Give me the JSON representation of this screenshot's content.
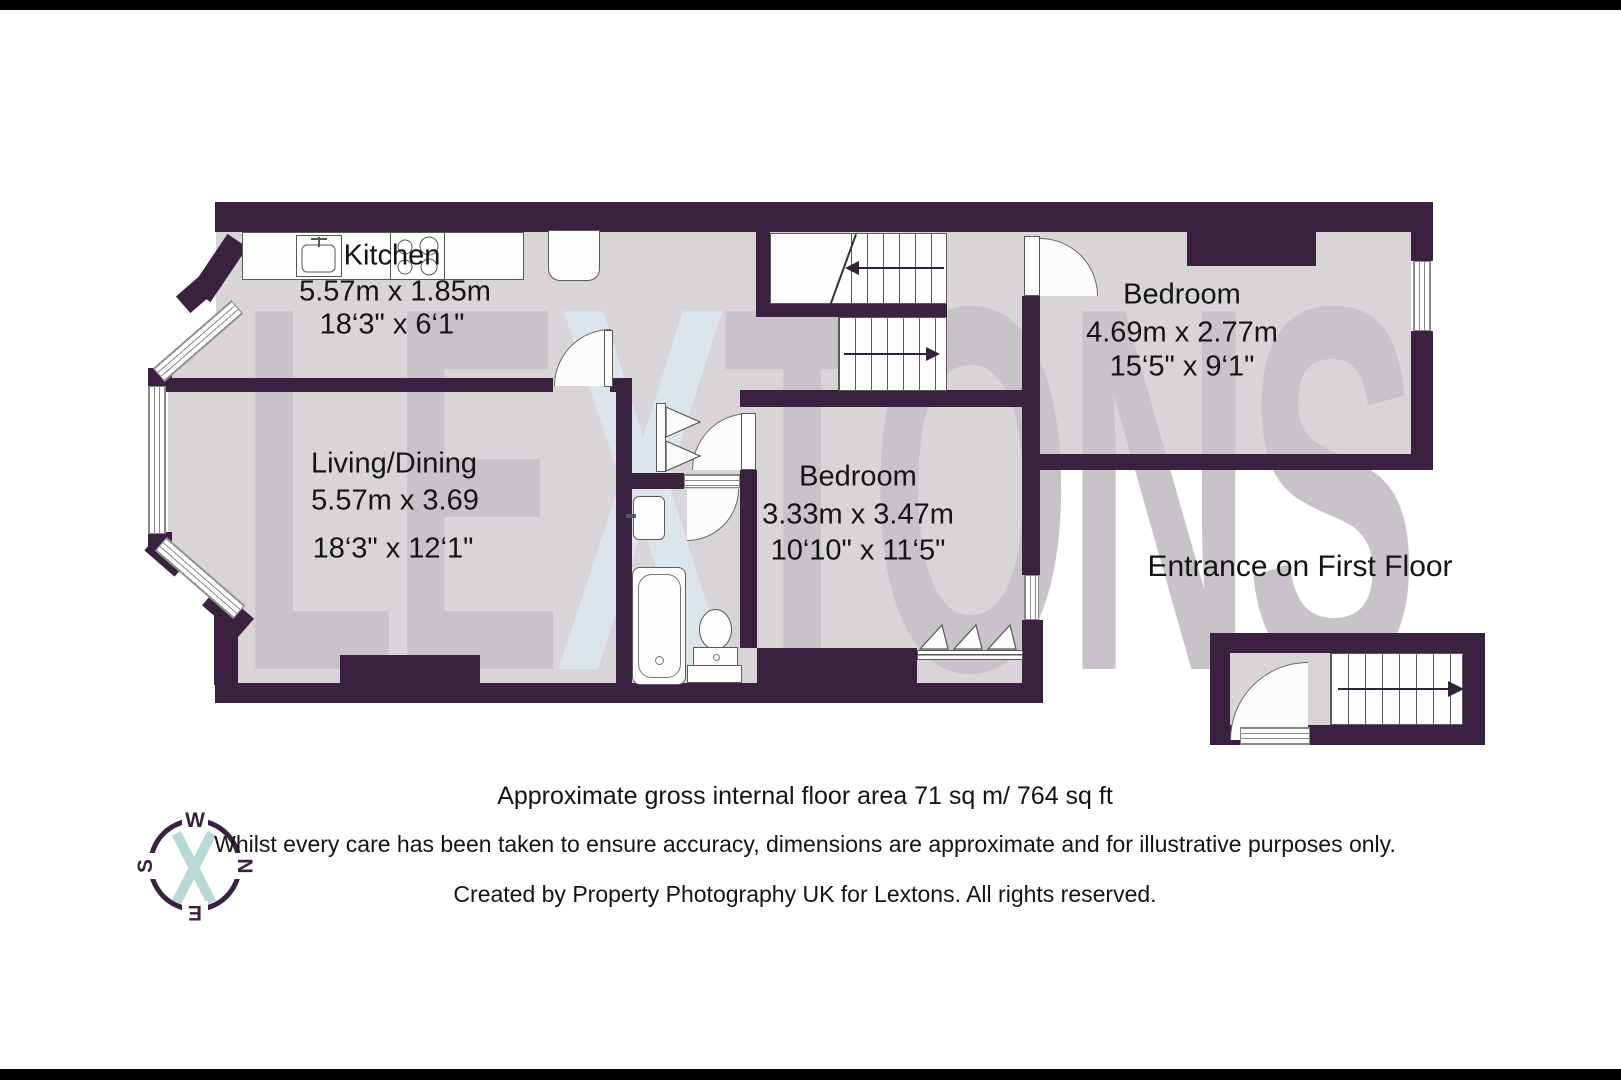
{
  "plan": {
    "rooms": {
      "kitchen": {
        "name": "Kitchen",
        "metric": "5.57m x 1.85m",
        "imperial": "18‘3\" x 6‘1\""
      },
      "living": {
        "name": "Living/Dining",
        "metric": "5.57m x 3.69",
        "imperial": "18‘3\" x 12‘1\""
      },
      "bedroom_middle": {
        "name": "Bedroom",
        "metric": "3.33m x 3.47m",
        "imperial": "10‘10\" x 11‘5\""
      },
      "bedroom_right": {
        "name": "Bedroom",
        "metric": "4.69m x 2.77m",
        "imperial": "15‘5\" x 9‘1\""
      }
    },
    "entrance_note": "Entrance on First Floor",
    "watermark": {
      "left": "LE",
      "x": "X",
      "right": "TONS"
    },
    "compass": {
      "top": "W",
      "right": "N",
      "bottom": "E",
      "left": "S"
    },
    "colors": {
      "wall": "#3a2140",
      "floor": "#d8d4d8",
      "watermark": "#c8c2c9",
      "watermark_x": "#dce6ea",
      "compass_x": "#b9d8d8"
    }
  },
  "footer": {
    "area": "Approximate gross internal floor area 71 sq m/ 764 sq ft",
    "disclaimer": "Whilst every care has been taken to ensure accuracy, dimensions are approximate and for illustrative purposes only.",
    "credit": "Created by Property Photography UK for Lextons. All rights reserved."
  }
}
